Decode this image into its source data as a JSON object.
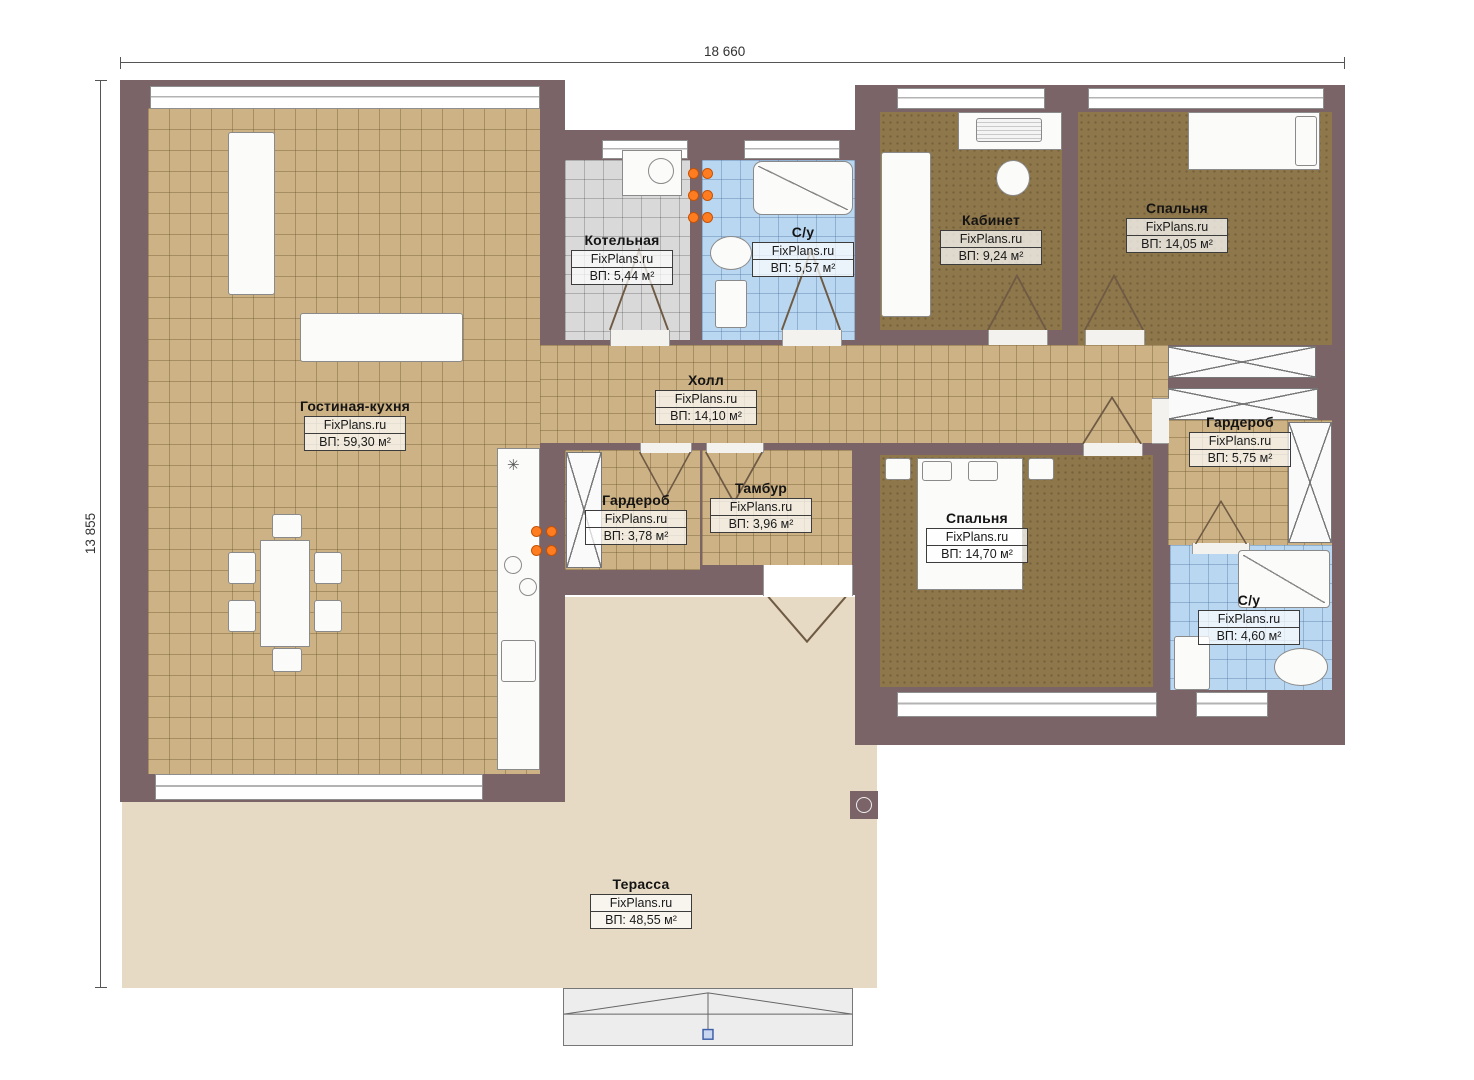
{
  "meta": {
    "plan_width_label": "18 660",
    "plan_height_label": "13 855",
    "brand": "FixPlans.ru"
  },
  "colors": {
    "wall": "#7b6468",
    "floor_tile_tan": "#cdb286",
    "floor_wood_brown": "#8f774c",
    "floor_tile_blue": "#b9d7f1",
    "floor_tile_gray": "#d9d9d9",
    "terrace": "#e6dac5",
    "stove_accent": "#ff7d20"
  },
  "rooms": [
    {
      "name": "Гостиная-кухня",
      "brand": "FixPlans.ru",
      "area": "ВП: 59,30 м²"
    },
    {
      "name": "Котельная",
      "brand": "FixPlans.ru",
      "area": "ВП: 5,44 м²"
    },
    {
      "name": "С/у",
      "brand": "FixPlans.ru",
      "area": "ВП: 5,57 м²"
    },
    {
      "name": "Кабинет",
      "brand": "FixPlans.ru",
      "area": "ВП: 9,24 м²"
    },
    {
      "name": "Спальня",
      "brand": "FixPlans.ru",
      "area": "ВП: 14,05 м²"
    },
    {
      "name": "Холл",
      "brand": "FixPlans.ru",
      "area": "ВП: 14,10 м²"
    },
    {
      "name": "Гардероб",
      "brand": "FixPlans.ru",
      "area": "ВП: 3,78 м²"
    },
    {
      "name": "Тамбур",
      "brand": "FixPlans.ru",
      "area": "ВП: 3,96 м²"
    },
    {
      "name": "Спальня",
      "brand": "FixPlans.ru",
      "area": "ВП: 14,70 м²"
    },
    {
      "name": "Гардероб",
      "brand": "FixPlans.ru",
      "area": "ВП: 5,75 м²"
    },
    {
      "name": "С/у",
      "brand": "FixPlans.ru",
      "area": "ВП: 4,60 м²"
    },
    {
      "name": "Терасса",
      "brand": "FixPlans.ru",
      "area": "ВП: 48,55 м²"
    }
  ]
}
